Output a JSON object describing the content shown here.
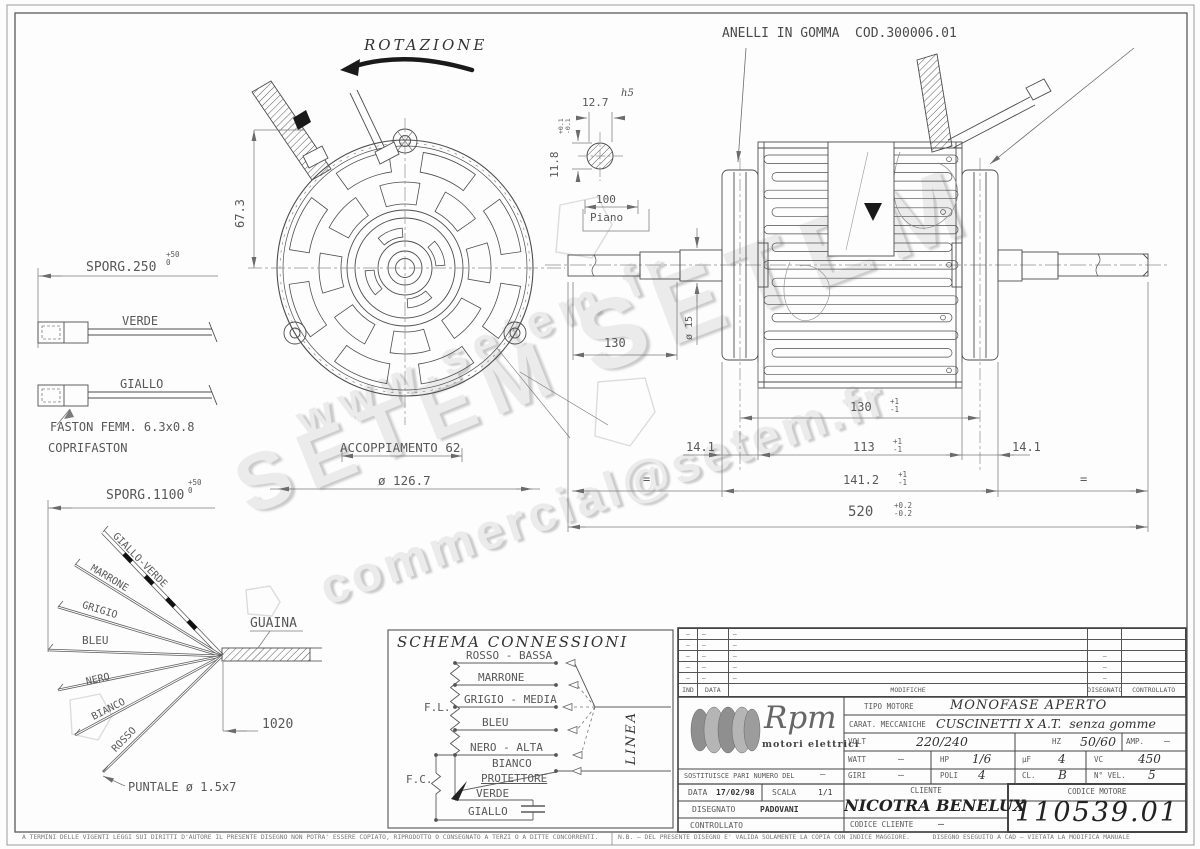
{
  "watermark": {
    "line1": "www.setem.fr",
    "line2": "SETEM",
    "line3": "SETEM",
    "line4": "commercial@setem.fr"
  },
  "annotations": {
    "rotazione": "ROTAZIONE",
    "anelli": "ANELLI IN GOMMA  COD.300006.01",
    "accoppiamento": "ACCOPPIAMENTO 62",
    "diametro_flangia": "ø 126.7",
    "guaina": "GUAINA",
    "puntale": "PUNTALE ø 1.5x7",
    "faston": "FASTON FEMM. 6.3x0.8",
    "coprifaston": "COPRIFASTON",
    "piano": "Piano",
    "h5": "h5",
    "eq": "="
  },
  "dimensions": {
    "d67": "67.3",
    "sporg250": "SPORG.250",
    "sporg1100": "SPORG.1100",
    "tol50p": "+50",
    "tol50z": "0",
    "d127": "12.7",
    "d118": "11.8",
    "tol01p": "+0.1",
    "tol01m": "-0.1",
    "d100": "100",
    "d130shaft": "130",
    "d15": "ø 15",
    "d130": "130",
    "d113": "113",
    "d141l": "14.1",
    "d141r": "14.1",
    "d1412": "141.2",
    "tolp1": "+1",
    "tolm1": "-1",
    "d520": "520",
    "tolp02": "+0.2",
    "tolm02": "-0.2",
    "d1020": "1020"
  },
  "left_wires": {
    "verde": "VERDE",
    "giallo": "GIALLO"
  },
  "fan_wires": [
    "GIALLO-VERDE",
    "MARRONE",
    "GRIGIO",
    "BLEU",
    "NERO",
    "BIANCO",
    "ROSSO"
  ],
  "schema": {
    "title": "SCHEMA CONNESSIONI",
    "fl": "F.L.",
    "fc": "F.C.",
    "linea": "LINEA",
    "rows": [
      "ROSSO - BASSA",
      "MARRONE",
      "GRIGIO - MEDIA",
      "BLEU",
      "NERO - ALTA",
      "BIANCO",
      "PROTETTORE",
      "VERDE",
      "GIALLO"
    ]
  },
  "revision": {
    "col_ind": "IND",
    "col_data": "DATA",
    "col_modifiche": "MODIFICHE",
    "col_disegnato": "DISEGNATO",
    "col_controllato": "CONTROLLATO",
    "rows": [
      {
        "ind": "–",
        "data": "–",
        "mod": "–",
        "dis": "",
        "con": ""
      },
      {
        "ind": "–",
        "data": "–",
        "mod": "–",
        "dis": "",
        "con": ""
      },
      {
        "ind": "–",
        "data": "–",
        "mod": "–",
        "dis": "–",
        "con": ""
      },
      {
        "ind": "–",
        "data": "–",
        "mod": "–",
        "dis": "–",
        "con": ""
      },
      {
        "ind": "–",
        "data": "–",
        "mod": "–",
        "dis": "–",
        "con": ""
      }
    ]
  },
  "title_block": {
    "logo_name": "Rpm",
    "logo_subtitle": "motori elettrici",
    "tipo_motore_label": "TIPO MOTORE",
    "tipo_motore": "MONOFASE APERTO",
    "carat_label": "CARAT. MECCANICHE",
    "carat": "CUSCINETTI X A.T.  senza gomme",
    "volt_label": "VOLT",
    "volt": "220/240",
    "hz_label": "HZ",
    "hz": "50/60",
    "amp_label": "AMP.",
    "amp": "–",
    "watt_label": "WATT",
    "watt": "–",
    "hp_label": "HP",
    "hp": "1/6",
    "uf_label": "µF",
    "uf": "4",
    "vc_label": "VC",
    "vc": "450",
    "giri_label": "GIRI",
    "giri": "–",
    "poli_label": "POLI",
    "poli": "4",
    "cl_label": "CL.",
    "cl": "B",
    "nvel_label": "N° VEL.",
    "nvel": "5",
    "sostituisce_label": "SOSTITUISCE PARI NUMERO DEL",
    "sostituisce": "–",
    "data_label": "DATA",
    "data": "17/02/98",
    "scala_label": "SCALA",
    "scala": "1/1",
    "disegnato_label": "DISEGNATO",
    "disegnato": "PADOVANI",
    "controllato_label": "CONTROLLATO",
    "cliente_label": "CLIENTE",
    "cliente": "NICOTRA BENELUX",
    "codice_cliente_label": "CODICE CLIENTE",
    "codice_cliente": "–",
    "codice_motore_label": "CODICE MOTORE",
    "codice_motore": "110539.01"
  },
  "footer": {
    "left": "A TERMINI DELLE VIGENTI LEGGI SUI DIRITTI D'AUTORE IL PRESENTE DISEGNO NON POTRA' ESSERE COPIATO, RIPRODOTTO O CONSEGNATO A TERZI O A DITTE CONCORRENTI.",
    "right": "N.B. – DEL PRESENTE DISEGNO E' VALIDA SOLAMENTE LA COPIA CON INDICE MAGGIORE.      DISEGNO ESEGUITO A CAD – VIETATA LA MODIFICA MANUALE"
  },
  "colors": {
    "line": "#4d4d4d",
    "dim": "#7a7a7a",
    "watermark": "#ebebeb",
    "black": "#1a1a1a"
  }
}
